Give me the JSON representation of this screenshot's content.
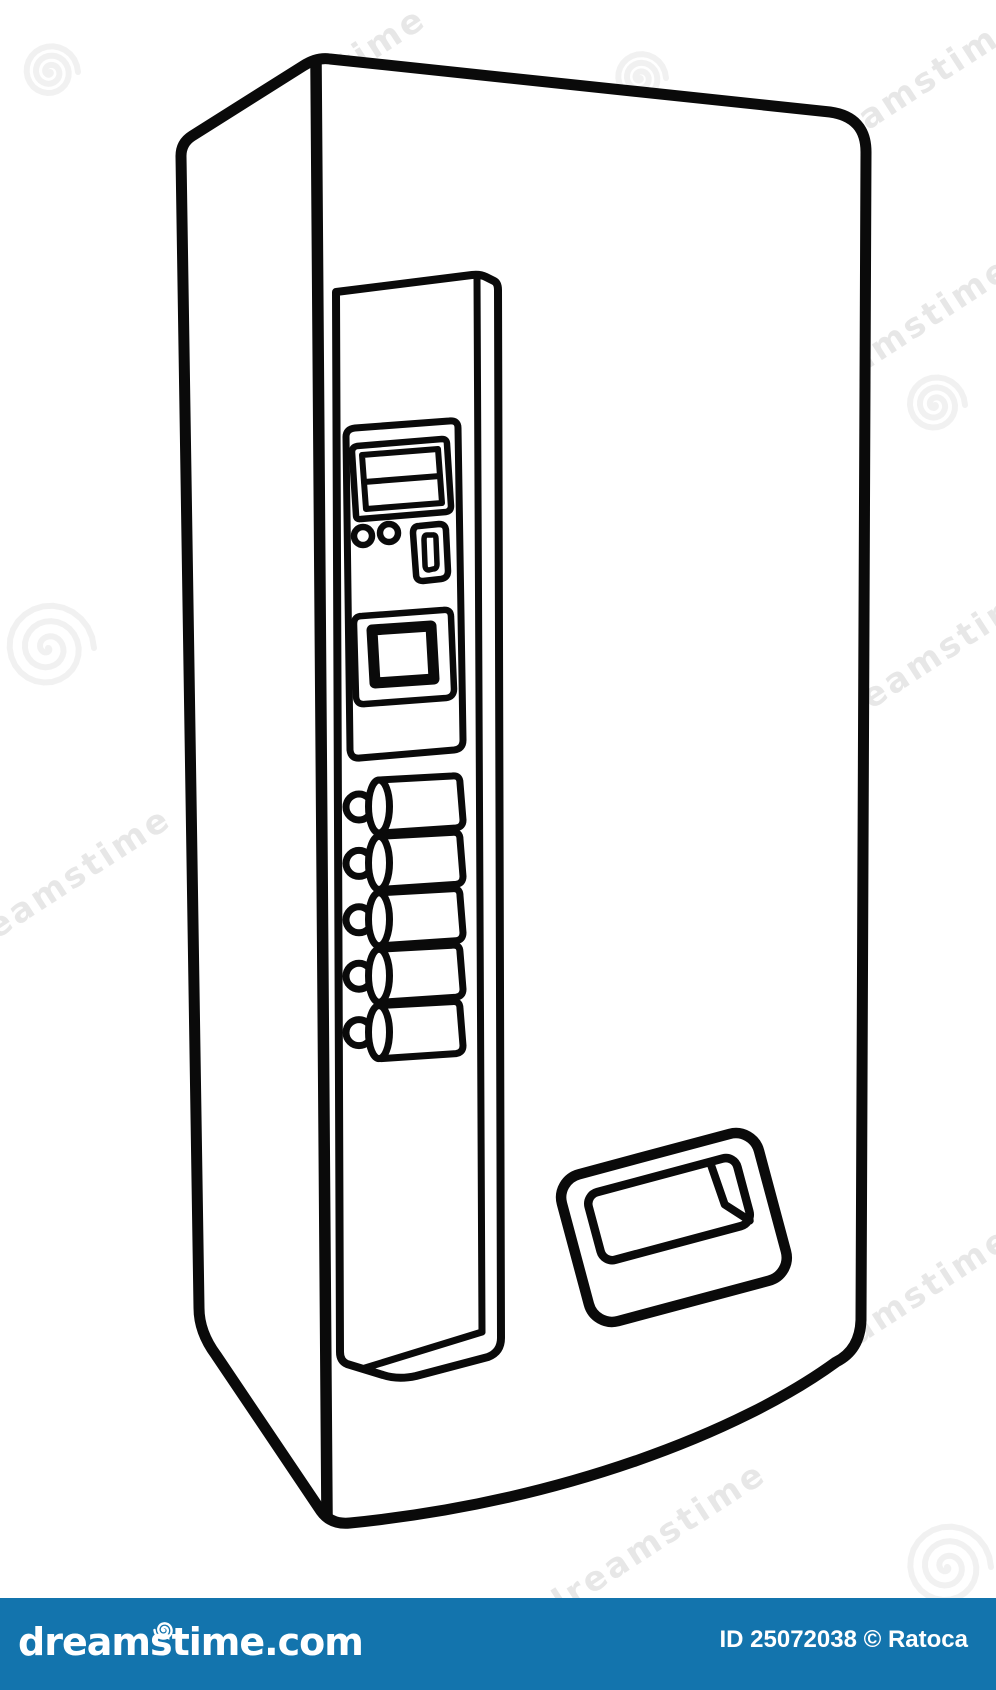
{
  "page": {
    "background": "#ffffff",
    "width": 996,
    "height": 1690
  },
  "illustration": {
    "subject": "vending machine",
    "style": "black outline cartoon line-art drawing, three-quarter perspective view",
    "line_color": "#000000",
    "parts": {
      "control_panel": "tall vertical panel on left side of machine front",
      "display_lines": 2,
      "coin_return_buttons": 2,
      "coin_slot": 1,
      "bill_acceptor": 1,
      "selection_buttons": 5,
      "dispenser_door": "recessed pickup flap at lower right"
    }
  },
  "watermark": {
    "text": "dreamstime",
    "spiral_icon": "spiral-watermark"
  },
  "footer": {
    "bar_color": "#1374ad",
    "text_color": "#ffffff",
    "logo_text": "dreamstime.com",
    "credit_text": "ID 25072038 © Ratoca"
  }
}
